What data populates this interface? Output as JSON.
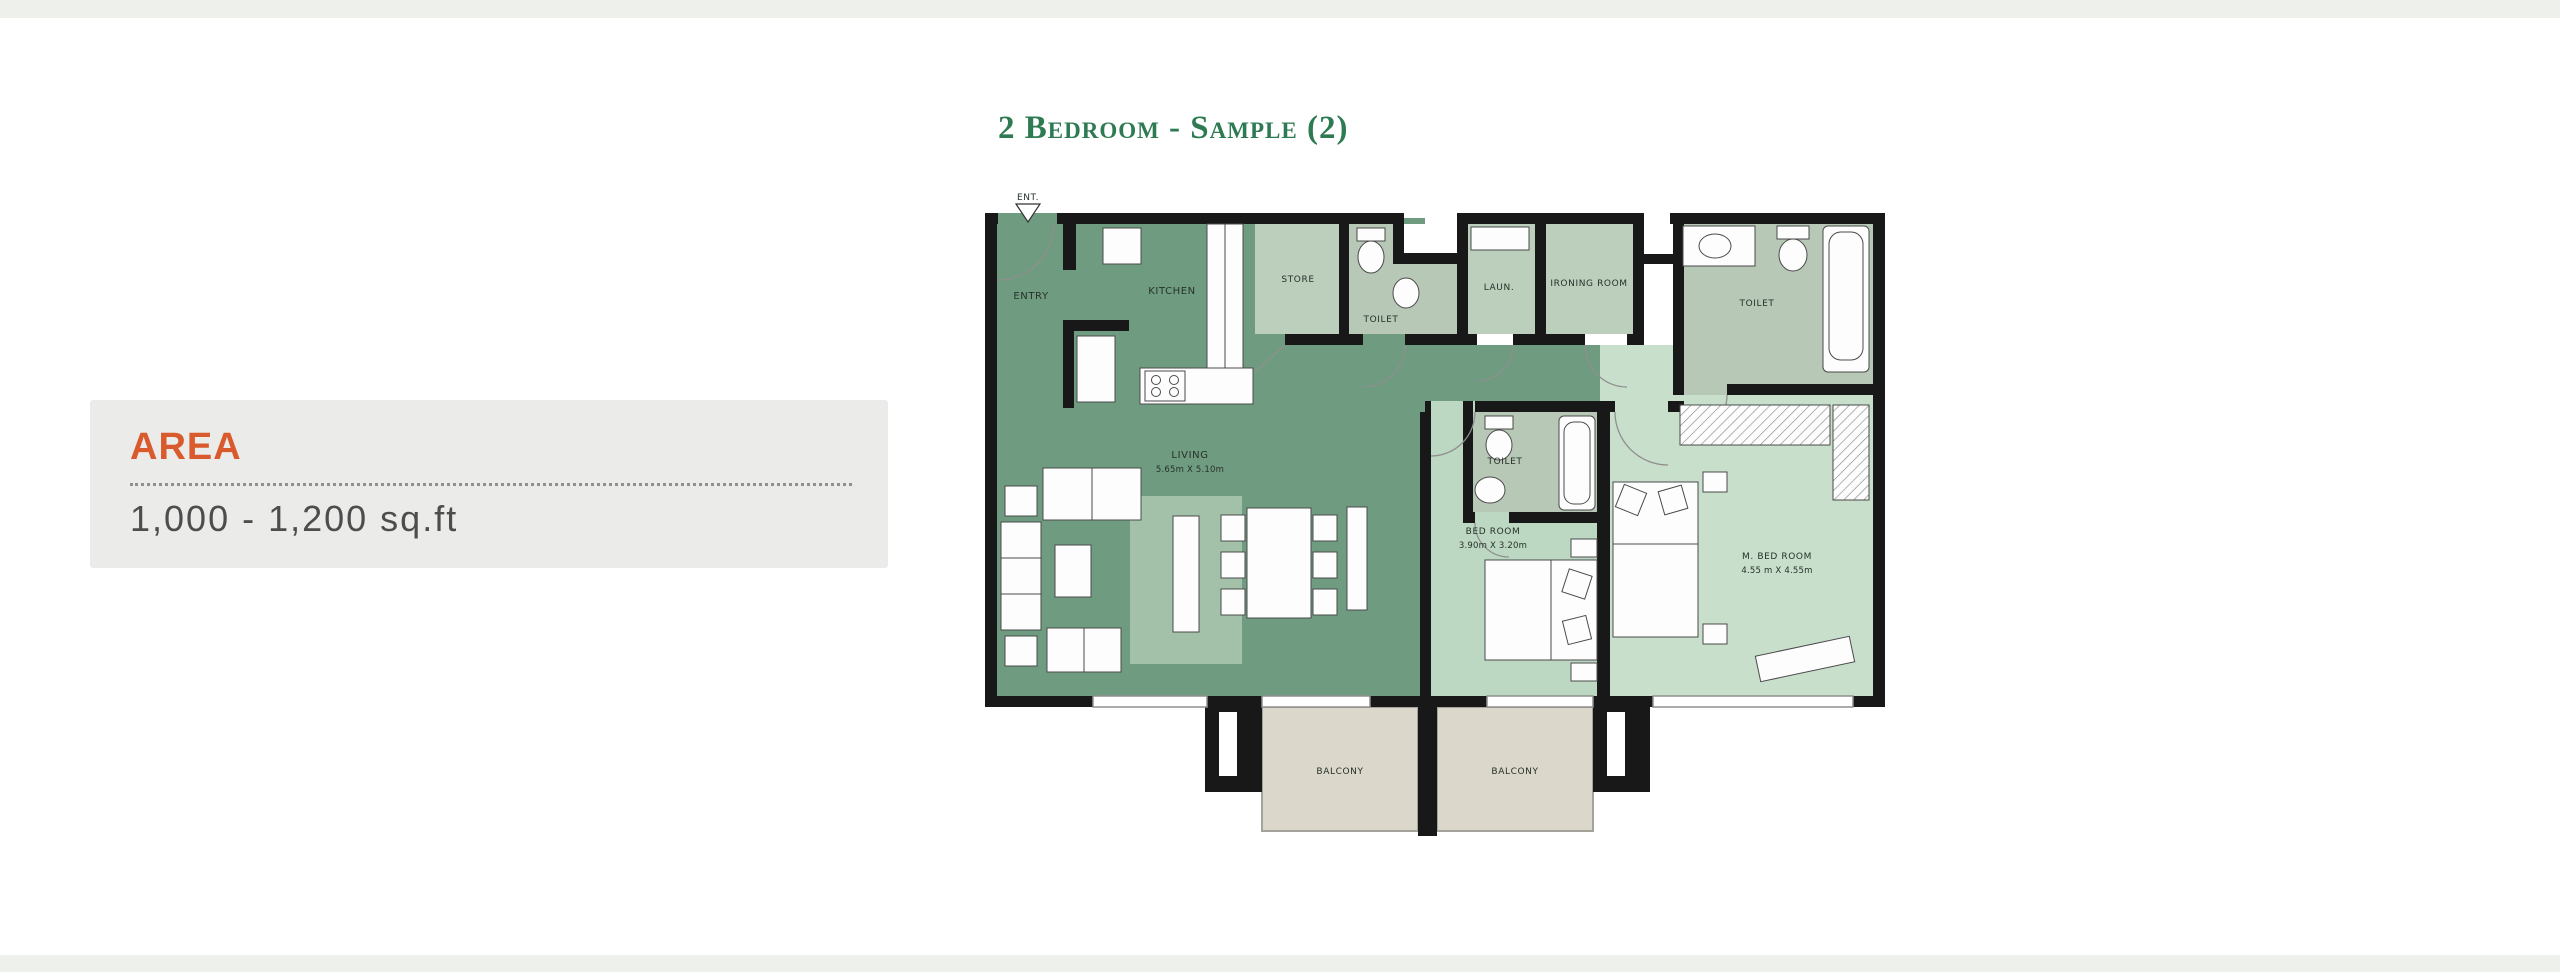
{
  "frame": {
    "strip_color": "#eef0ec"
  },
  "title": {
    "text": "2 Bedroom - Sample (2)",
    "color": "#2e7b53"
  },
  "area_panel": {
    "heading": "AREA",
    "heading_color": "#d95b2d",
    "value": "1,000 - 1,200 sq.ft",
    "value_color": "#4d4d4d",
    "background": "#ebecea"
  },
  "plan": {
    "entry_marker": "ENT.",
    "labels": {
      "entry": "ENTRY",
      "kitchen": "KITCHEN",
      "store": "STORE",
      "toilet_guest": "TOILET",
      "laundry": "LAUN.",
      "ironing_room": "IRONING ROOM",
      "toilet_master": "TOILET",
      "living": "LIVING",
      "living_dims": "5.65m X 5.10m",
      "bedroom": "BED ROOM",
      "bedroom_dims": "3.90m X 3.20m",
      "toilet_bedroom": "TOILET",
      "master_bedroom": "M. BED ROOM",
      "master_bedroom_dims": "4.55 m X 4.55m",
      "balcony_left": "BALCONY",
      "balcony_right": "BALCONY"
    },
    "colors": {
      "living_green": "#6f9c80",
      "rug_green": "#a2c1a8",
      "bedroom_green": "#bdd8c2",
      "master_green": "#c8dfcc",
      "service_green": "#bccfbc",
      "toilet_green": "#b7c8b6",
      "balcony_beige": "#dbd7cb",
      "wall_black": "#181818",
      "window_gray": "#8f8f8f"
    }
  }
}
